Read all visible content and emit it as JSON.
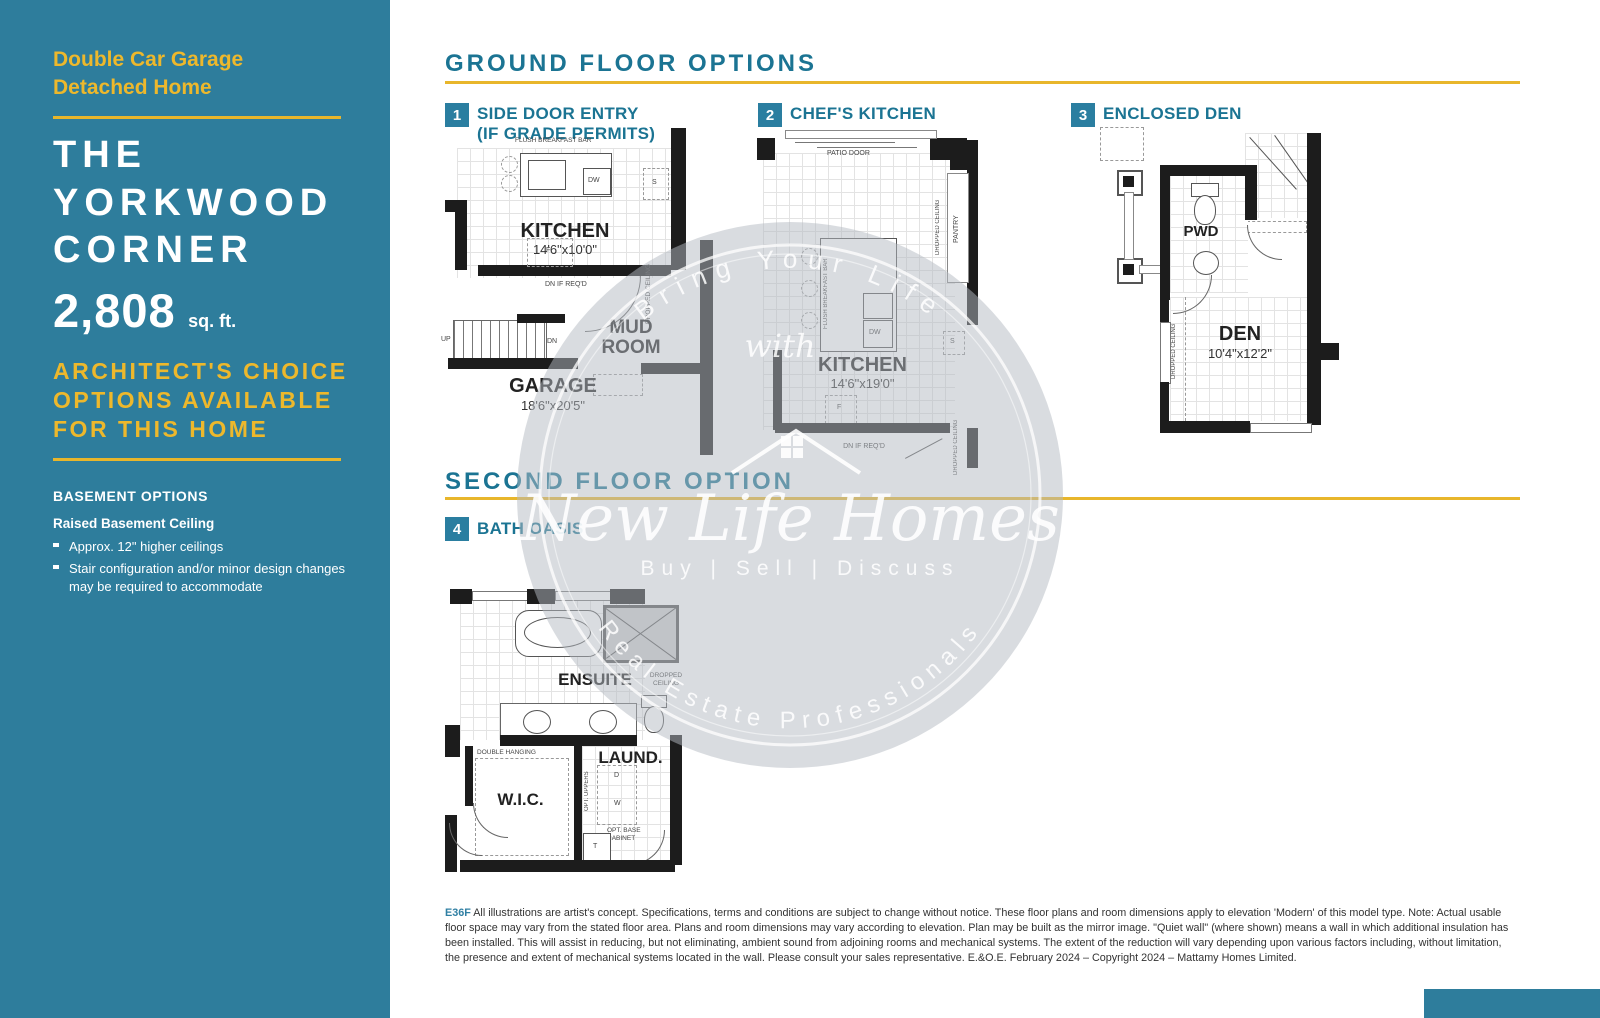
{
  "colors": {
    "sidebar_teal": "#2E7D9C",
    "heading_teal": "#1B7493",
    "gold": "#E8B62B",
    "wall_black": "#1C1C1C",
    "watermark_gray": "#B3BAC1"
  },
  "sidebar": {
    "subtitle_line1": "Double Car Garage",
    "subtitle_line2": "Detached Home",
    "title_line1": "THE",
    "title_line2": "YORKWOOD",
    "title_line3": "CORNER",
    "sqft_value": "2,808",
    "sqft_unit": "sq. ft.",
    "choice_line1": "ARCHITECT'S CHOICE",
    "choice_line2": "OPTIONS AVAILABLE",
    "choice_line3": "FOR THIS HOME",
    "basement_heading": "BASEMENT OPTIONS",
    "basement_title": "Raised Basement Ceiling",
    "bullet1": "Approx. 12\" higher ceilings",
    "bullet2": "Stair configuration and/or minor design changes may be required to accommodate"
  },
  "sections": {
    "ground_title": "GROUND FLOOR OPTIONS",
    "second_title": "SECOND FLOOR OPTION"
  },
  "options": {
    "opt1_num": "1",
    "opt1_line1": "SIDE DOOR ENTRY",
    "opt1_line2": "(IF GRADE PERMITS)",
    "opt2_num": "2",
    "opt2_label": "CHEF'S KITCHEN",
    "opt3_num": "3",
    "opt3_label": "ENCLOSED DEN",
    "opt4_num": "4",
    "opt4_label": "BATH OASIS"
  },
  "plan1": {
    "breakfast_bar": "FLUSH BREAKFAST BAR",
    "dw": "DW",
    "s": "S",
    "f": "F",
    "room": "KITCHEN",
    "dims": "14'6\"x10'0\"",
    "dn_note": "DN IF REQ'D",
    "dropped": "DROPPED CEILING",
    "up": "UP",
    "dn": "DN",
    "mud1": "MUD",
    "mud2": "ROOM",
    "garage": "GARAGE",
    "garage_dims": "18'6\"x20'5\""
  },
  "plan2": {
    "patio": "PATIO DOOR",
    "dropped": "DROPPED CEILING",
    "pantry": "PANTRY",
    "breakfast_bar": "FLUSH BREAKFAST BAR",
    "dw": "DW",
    "s": "S",
    "f": "F",
    "room": "KITCHEN",
    "dims": "14'6\"x19'0\"",
    "dn_note": "DN IF REQ'D",
    "dropped2": "DROPPED CEILING"
  },
  "plan3": {
    "pwd": "PWD",
    "room": "DEN",
    "dims": "10'4\"x12'2\"",
    "dropped": "DROPPED CEILING"
  },
  "plan4": {
    "ensuite": "ENSUITE",
    "dropped": "DROPPED CEILING",
    "double_hanging": "DOUBLE HANGING",
    "wic": "W.I.C.",
    "laund": "LAUND.",
    "opt_uppers": "OPT. UPPERS",
    "d": "D",
    "w": "W",
    "t": "T",
    "opt_base1": "OPT. BASE",
    "opt_base2": "CABINET"
  },
  "watermark": {
    "arc_top": "Bring Your Life",
    "middle": "with",
    "brand": "New Life Homes",
    "tagline": "Buy | Sell | Discuss",
    "arc_bottom": "Real Estate Professionals"
  },
  "footer": {
    "code": "E36F",
    "text": "All illustrations are artist's concept. Specifications, terms and conditions are subject to change without notice. These floor plans and room dimensions apply to elevation 'Modern' of this model type. Note: Actual usable floor space may vary from the stated floor area. Plans and room dimensions may vary according to elevation. Plan may be built as the mirror image. \"Quiet wall\" (where shown) means a wall in which additional insulation has been installed. This will assist in reducing, but not eliminating, ambient sound from adjoining rooms and mechanical systems. The extent of the reduction will vary depending upon various factors including, without limitation, the presence and extent of mechanical systems located in the wall. Please consult your sales representative. E.&O.E. February 2024 – Copyright 2024 – Mattamy Homes Limited."
  }
}
